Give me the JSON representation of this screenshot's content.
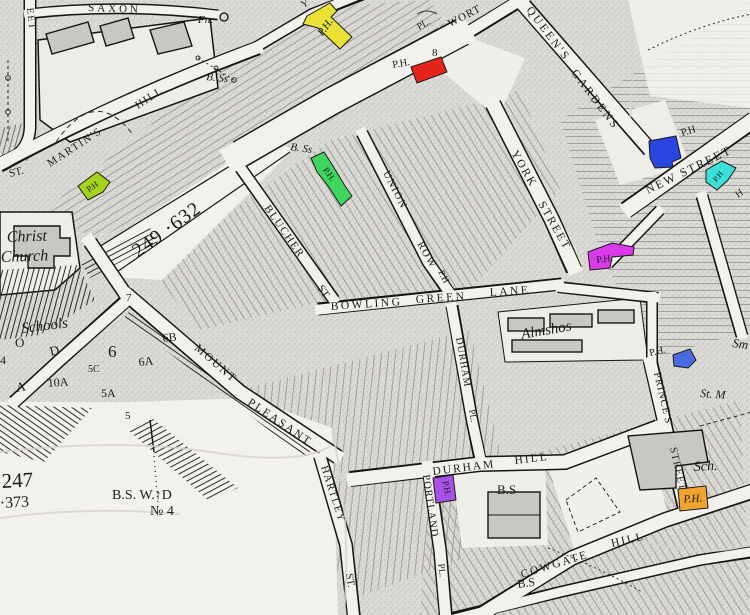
{
  "map": {
    "kind": "historic-ordnance-town-plan",
    "paper_color": "#f2f0ec",
    "ink_color": "#1c1b19",
    "labels": {
      "saxon": "SAXON",
      "eet": "EET",
      "fn": "Fn.",
      "bss1": "B. Ss",
      "bss2": "B. Ss",
      "st_abbrev": "ST.",
      "martins": "MARTIN'S",
      "martins_hill": "HILL",
      "y_frag": "Y",
      "pl_frag": "PL.",
      "wort": "WORT",
      "eight": "8",
      "queens": "QUEEN'S",
      "gardens": "GARDENS",
      "new_street": "NEW STREET",
      "h_frag": "H",
      "union": "UNION",
      "row": "ROW",
      "union_ph": "P.H",
      "york": "YORK",
      "york_street": "STREET",
      "christ": "Christ",
      "church": "Church",
      "parcel_249": "249 ·632",
      "seven": "7",
      "schools": "Schools",
      "o_frag": "O",
      "d_frag": "D",
      "a_frag": "A",
      "four_frag": "4",
      "n10a": "10A",
      "n6": "6",
      "n5c": "5C",
      "n6a": "6A",
      "n6b": "6B",
      "n5a": "5A",
      "n5": "5",
      "mount": "MOUNT",
      "pleasant": "PLEASANT",
      "blucher": "BLUCHER",
      "blucher_st": "ST.",
      "bowling": "BOWLING",
      "green_word": "GREEN",
      "lane": "LANE",
      "almshos": "Almshos",
      "durham_pl": "DURHAM",
      "durham_pl_suffix": "PL.",
      "princes": "PRINCE'S",
      "princes_street": "STREET",
      "sm_frag": "Sm",
      "st_m_frag": "St. M",
      "sch": "Sch.",
      "hartley": "HARTLEY",
      "hartley_st": "ST.",
      "portland": "PORTLAND",
      "portland_pl": "PL.",
      "durham_hill_1": "DURHAM",
      "durham_hill_2": "HILL",
      "bs_plaza": "B.S",
      "bs_lower": "B.S",
      "cowgate": "COWGATE",
      "cowgate_hill": "HILL",
      "parcel_247": "247",
      "parcel_373": "·373",
      "bsw_no4_line1": "B.S. W.↑D",
      "bsw_no4_line2": "№ 4",
      "ph_red": "P.H.",
      "ph_new_street": "P.H",
      "ph_princes": "P.H."
    },
    "highlights": {
      "chartreuse": {
        "color": "#a4d51e",
        "label": "P.H"
      },
      "yellow": {
        "color": "#e9e234",
        "label": "P.H."
      },
      "red": {
        "color": "#e5251b"
      },
      "green": {
        "color": "#3ed65c",
        "label": "P.H."
      },
      "blue": {
        "color": "#2947e0"
      },
      "cyan": {
        "color": "#3ae1d8",
        "label": "P.H"
      },
      "magenta": {
        "color": "#d93bea",
        "label": "P.H."
      },
      "blue_small": {
        "color": "#4a6be2"
      },
      "purple": {
        "color": "#a751e8",
        "label": "P.H."
      },
      "orange": {
        "color": "#f0a42e",
        "label": "P.H."
      }
    }
  }
}
